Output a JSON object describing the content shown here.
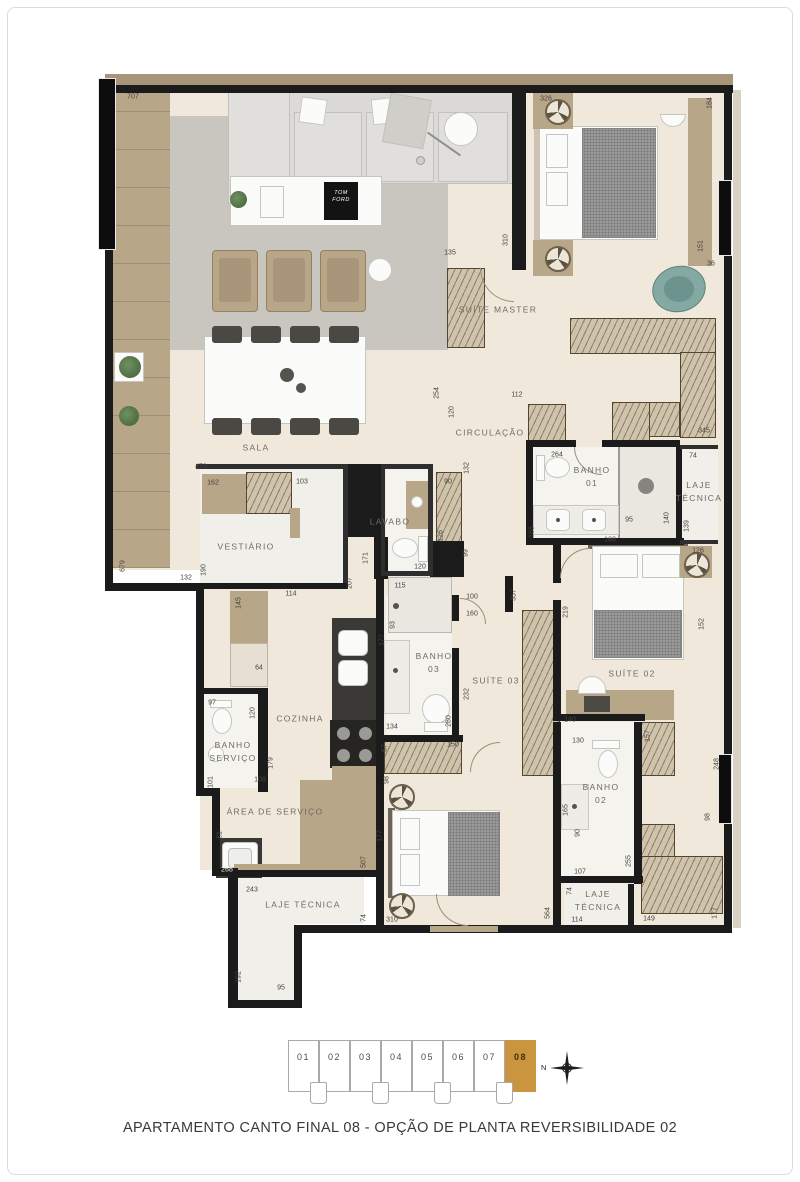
{
  "caption": "APARTAMENTO CANTO FINAL 08 - OPÇÃO DE PLANTA REVERSIBILIDADE 02",
  "plan": {
    "colors": {
      "wall": "#1b1b1b",
      "floor": "#f0e9db",
      "wood": "#b8a689",
      "teal_chair": "#84a9a3"
    },
    "decor": {
      "book_label": "TOM\nFORD"
    },
    "rooms": [
      {
        "label": "SALA",
        "x": 256,
        "y": 448
      },
      {
        "label": "SUÍTE MASTER",
        "x": 498,
        "y": 310
      },
      {
        "label": "CIRCULAÇÃO",
        "x": 490,
        "y": 433
      },
      {
        "label": "BANHO\n01",
        "x": 592,
        "y": 477
      },
      {
        "label": "LAJE\nTÉCNICA",
        "x": 699,
        "y": 492
      },
      {
        "label": "VESTIÁRIO",
        "x": 246,
        "y": 547
      },
      {
        "label": "LAVABO",
        "x": 390,
        "y": 522
      },
      {
        "label": "COZINHA",
        "x": 300,
        "y": 719
      },
      {
        "label": "BANHO\n03",
        "x": 434,
        "y": 663
      },
      {
        "label": "SUÍTE 03",
        "x": 496,
        "y": 681
      },
      {
        "label": "SUÍTE 02",
        "x": 632,
        "y": 674
      },
      {
        "label": "BANHO\nSERVIÇO",
        "x": 233,
        "y": 752
      },
      {
        "label": "ÁREA DE SERVIÇO",
        "x": 275,
        "y": 812
      },
      {
        "label": "BANHO\n02",
        "x": 601,
        "y": 794
      },
      {
        "label": "LAJE TÉCNICA",
        "x": 303,
        "y": 905
      },
      {
        "label": "LAJE\nTÉCNICA",
        "x": 598,
        "y": 901
      }
    ],
    "dims": [
      {
        "t": "707",
        "x": 133,
        "y": 97,
        "o": "h"
      },
      {
        "t": "326",
        "x": 546,
        "y": 99,
        "o": "h"
      },
      {
        "t": "184",
        "x": 710,
        "y": 103,
        "o": "v"
      },
      {
        "t": "151",
        "x": 701,
        "y": 246,
        "o": "v"
      },
      {
        "t": "36",
        "x": 711,
        "y": 264,
        "o": "h"
      },
      {
        "t": "135",
        "x": 450,
        "y": 253,
        "o": "h"
      },
      {
        "t": "310",
        "x": 506,
        "y": 240,
        "o": "v"
      },
      {
        "t": "254",
        "x": 437,
        "y": 393,
        "o": "v"
      },
      {
        "t": "120",
        "x": 452,
        "y": 412,
        "o": "v"
      },
      {
        "t": "112",
        "x": 517,
        "y": 395,
        "o": "h"
      },
      {
        "t": "132",
        "x": 467,
        "y": 468,
        "o": "v"
      },
      {
        "t": "264",
        "x": 557,
        "y": 455,
        "o": "h"
      },
      {
        "t": "345",
        "x": 704,
        "y": 431,
        "o": "h"
      },
      {
        "t": "74",
        "x": 693,
        "y": 456,
        "o": "h"
      },
      {
        "t": "95",
        "x": 629,
        "y": 520,
        "o": "h"
      },
      {
        "t": "140",
        "x": 667,
        "y": 518,
        "o": "v"
      },
      {
        "t": "139",
        "x": 687,
        "y": 526,
        "o": "v"
      },
      {
        "t": "165",
        "x": 532,
        "y": 532,
        "o": "v"
      },
      {
        "t": "168",
        "x": 610,
        "y": 540,
        "o": "h"
      },
      {
        "t": "473",
        "x": 201,
        "y": 467,
        "o": "h"
      },
      {
        "t": "162",
        "x": 213,
        "y": 483,
        "o": "h"
      },
      {
        "t": "103",
        "x": 302,
        "y": 482,
        "o": "h"
      },
      {
        "t": "679",
        "x": 123,
        "y": 566,
        "o": "v"
      },
      {
        "t": "132",
        "x": 186,
        "y": 578,
        "o": "h"
      },
      {
        "t": "190",
        "x": 204,
        "y": 570,
        "o": "v"
      },
      {
        "t": "114",
        "x": 291,
        "y": 594,
        "o": "h"
      },
      {
        "t": "207",
        "x": 350,
        "y": 583,
        "o": "v"
      },
      {
        "t": "171",
        "x": 366,
        "y": 558,
        "o": "v"
      },
      {
        "t": "120",
        "x": 420,
        "y": 567,
        "o": "h"
      },
      {
        "t": "90",
        "x": 448,
        "y": 482,
        "o": "h"
      },
      {
        "t": "126",
        "x": 441,
        "y": 536,
        "o": "v"
      },
      {
        "t": "99",
        "x": 466,
        "y": 553,
        "o": "v"
      },
      {
        "t": "357",
        "x": 514,
        "y": 595,
        "o": "v"
      },
      {
        "t": "100",
        "x": 472,
        "y": 597,
        "o": "h"
      },
      {
        "t": "160",
        "x": 472,
        "y": 614,
        "o": "h"
      },
      {
        "t": "219",
        "x": 566,
        "y": 612,
        "o": "v"
      },
      {
        "t": "145",
        "x": 239,
        "y": 603,
        "o": "v"
      },
      {
        "t": "64",
        "x": 259,
        "y": 668,
        "o": "h"
      },
      {
        "t": "97",
        "x": 212,
        "y": 703,
        "o": "h"
      },
      {
        "t": "120",
        "x": 253,
        "y": 713,
        "o": "v"
      },
      {
        "t": "179",
        "x": 271,
        "y": 763,
        "o": "v"
      },
      {
        "t": "108",
        "x": 260,
        "y": 780,
        "o": "h"
      },
      {
        "t": "101",
        "x": 211,
        "y": 782,
        "o": "v"
      },
      {
        "t": "81",
        "x": 220,
        "y": 835,
        "o": "v"
      },
      {
        "t": "268",
        "x": 227,
        "y": 870,
        "o": "h",
        "inv": true
      },
      {
        "t": "507",
        "x": 364,
        "y": 862,
        "o": "v"
      },
      {
        "t": "243",
        "x": 252,
        "y": 890,
        "o": "h"
      },
      {
        "t": "192",
        "x": 239,
        "y": 977,
        "o": "v"
      },
      {
        "t": "95",
        "x": 281,
        "y": 988,
        "o": "h"
      },
      {
        "t": "74",
        "x": 364,
        "y": 918,
        "o": "v"
      },
      {
        "t": "310",
        "x": 392,
        "y": 920,
        "o": "h"
      },
      {
        "t": "115",
        "x": 400,
        "y": 586,
        "o": "h"
      },
      {
        "t": "93",
        "x": 393,
        "y": 625,
        "o": "v"
      },
      {
        "t": "177",
        "x": 382,
        "y": 640,
        "o": "v"
      },
      {
        "t": "134",
        "x": 392,
        "y": 727,
        "o": "h"
      },
      {
        "t": "280",
        "x": 449,
        "y": 721,
        "o": "v"
      },
      {
        "t": "232",
        "x": 467,
        "y": 694,
        "o": "v"
      },
      {
        "t": "57",
        "x": 385,
        "y": 748,
        "o": "v"
      },
      {
        "t": "150",
        "x": 453,
        "y": 745,
        "o": "h"
      },
      {
        "t": "98",
        "x": 387,
        "y": 780,
        "o": "v"
      },
      {
        "t": "177",
        "x": 380,
        "y": 836,
        "o": "v"
      },
      {
        "t": "564",
        "x": 548,
        "y": 913,
        "o": "v"
      },
      {
        "t": "126",
        "x": 698,
        "y": 551,
        "o": "h"
      },
      {
        "t": "152",
        "x": 702,
        "y": 624,
        "o": "v"
      },
      {
        "t": "140",
        "x": 570,
        "y": 720,
        "o": "h"
      },
      {
        "t": "130",
        "x": 578,
        "y": 741,
        "o": "h"
      },
      {
        "t": "165",
        "x": 566,
        "y": 810,
        "o": "v"
      },
      {
        "t": "90",
        "x": 578,
        "y": 833,
        "o": "v"
      },
      {
        "t": "107",
        "x": 580,
        "y": 872,
        "o": "h"
      },
      {
        "t": "255",
        "x": 629,
        "y": 861,
        "o": "v"
      },
      {
        "t": "157",
        "x": 648,
        "y": 736,
        "o": "v"
      },
      {
        "t": "248",
        "x": 717,
        "y": 764,
        "o": "v"
      },
      {
        "t": "98",
        "x": 708,
        "y": 817,
        "o": "v"
      },
      {
        "t": "74",
        "x": 570,
        "y": 891,
        "o": "v"
      },
      {
        "t": "114",
        "x": 577,
        "y": 920,
        "o": "h"
      },
      {
        "t": "149",
        "x": 649,
        "y": 919,
        "o": "h"
      },
      {
        "t": "177",
        "x": 715,
        "y": 913,
        "o": "v"
      }
    ]
  },
  "keyplan": {
    "units": [
      {
        "label": "01",
        "active": false
      },
      {
        "label": "02",
        "active": false
      },
      {
        "label": "03",
        "active": false
      },
      {
        "label": "04",
        "active": false
      },
      {
        "label": "05",
        "active": false
      },
      {
        "label": "06",
        "active": false
      },
      {
        "label": "07",
        "active": false
      },
      {
        "label": "08",
        "active": true
      }
    ],
    "active_color": "#c9953f",
    "compass_label": "N"
  }
}
